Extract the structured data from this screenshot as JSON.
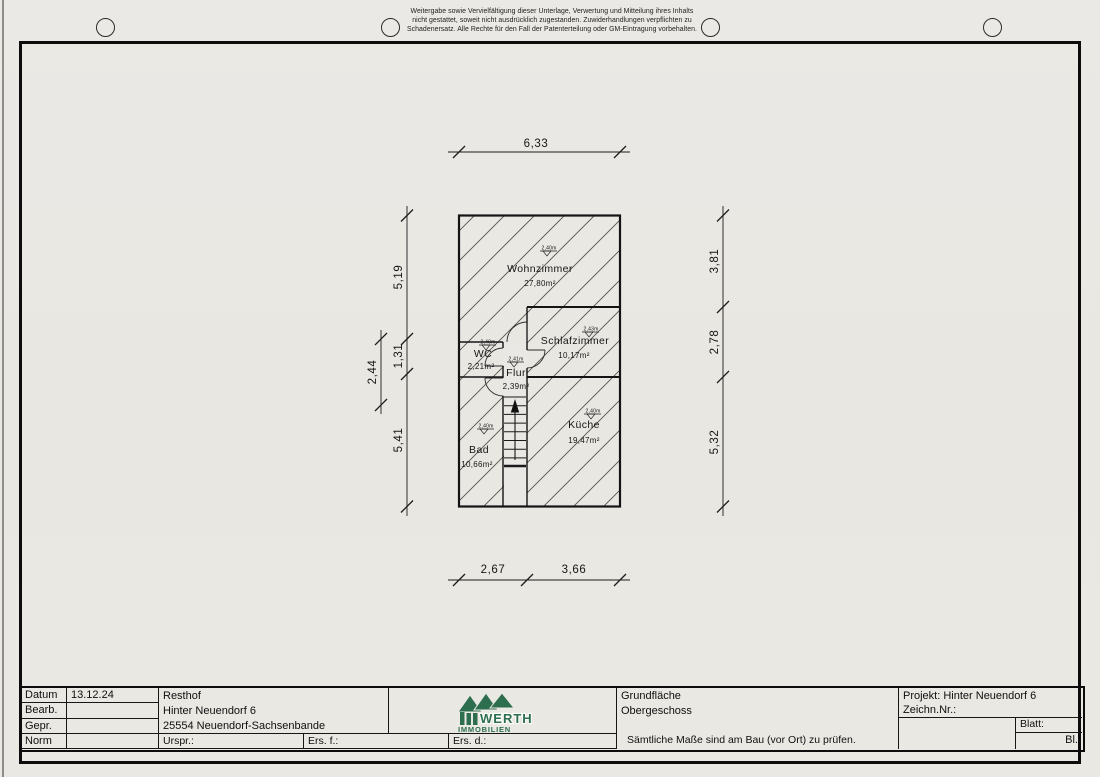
{
  "disclaimer": {
    "lines": [
      "Weitergabe sowie Vervielfältigung dieser Unterlage, Verwertung und Mitteilung ihres Inhalts",
      "nicht gestattet, soweit nicht ausdrücklich zugestanden. Zuwiderhandlungen verpflichten zu",
      "Schadenersatz. Alle Rechte für den Fall der Patenterteilung oder GM-Eintragung vorbehalten."
    ]
  },
  "plan": {
    "rooms": [
      {
        "name": "Wohnzimmer",
        "area": "27,80m²",
        "ceiling": "2,40m"
      },
      {
        "name": "Schlafzimmer",
        "area": "10,17m²",
        "ceiling": "2,43m"
      },
      {
        "name": "WC",
        "area": "2,21m²",
        "ceiling": "2,40m"
      },
      {
        "name": "Flur",
        "area": "2,39m²",
        "ceiling": "2,41m"
      },
      {
        "name": "Küche",
        "area": "19,47m²",
        "ceiling": "2,40m"
      },
      {
        "name": "Bad",
        "area": "10,66m²",
        "ceiling": "2,40m"
      }
    ],
    "dimensions": {
      "top": "6,33",
      "left_top": "5,19",
      "left_mid": "1,31",
      "left_outer": "2,44",
      "left_bottom": "5,41",
      "right_top": "3,81",
      "right_mid": "2,78",
      "right_bottom": "5,32",
      "bottom_left": "2,67",
      "bottom_right": "3,66"
    }
  },
  "titleblock": {
    "labels": {
      "datum": "Datum",
      "bearb": "Bearb.",
      "gepr": "Gepr.",
      "norm": "Norm"
    },
    "datum_value": "13.12.24",
    "address": {
      "line1": "Resthof",
      "line2": "Hinter Neuendorf 6",
      "line3": "25554 Neuendorf-Sachsenbande"
    },
    "revision": {
      "urspr": "Urspr.:",
      "ers_f": "Ers. f.:",
      "ers_d": "Ers. d.:"
    },
    "logo": {
      "brand": "WERTH",
      "sub": "IMMOBILIEN",
      "color": "#2d6e4f"
    },
    "content": {
      "line1": "Grundfläche",
      "line2": "Obergeschoss",
      "note": "Sämtliche Maße sind am Bau (vor Ort) zu prüfen."
    },
    "project": {
      "projekt": "Projekt: Hinter Neuendorf 6",
      "zeichn": "Zeichn.Nr.:",
      "blatt": "Blatt:",
      "bl": "Bl."
    }
  }
}
